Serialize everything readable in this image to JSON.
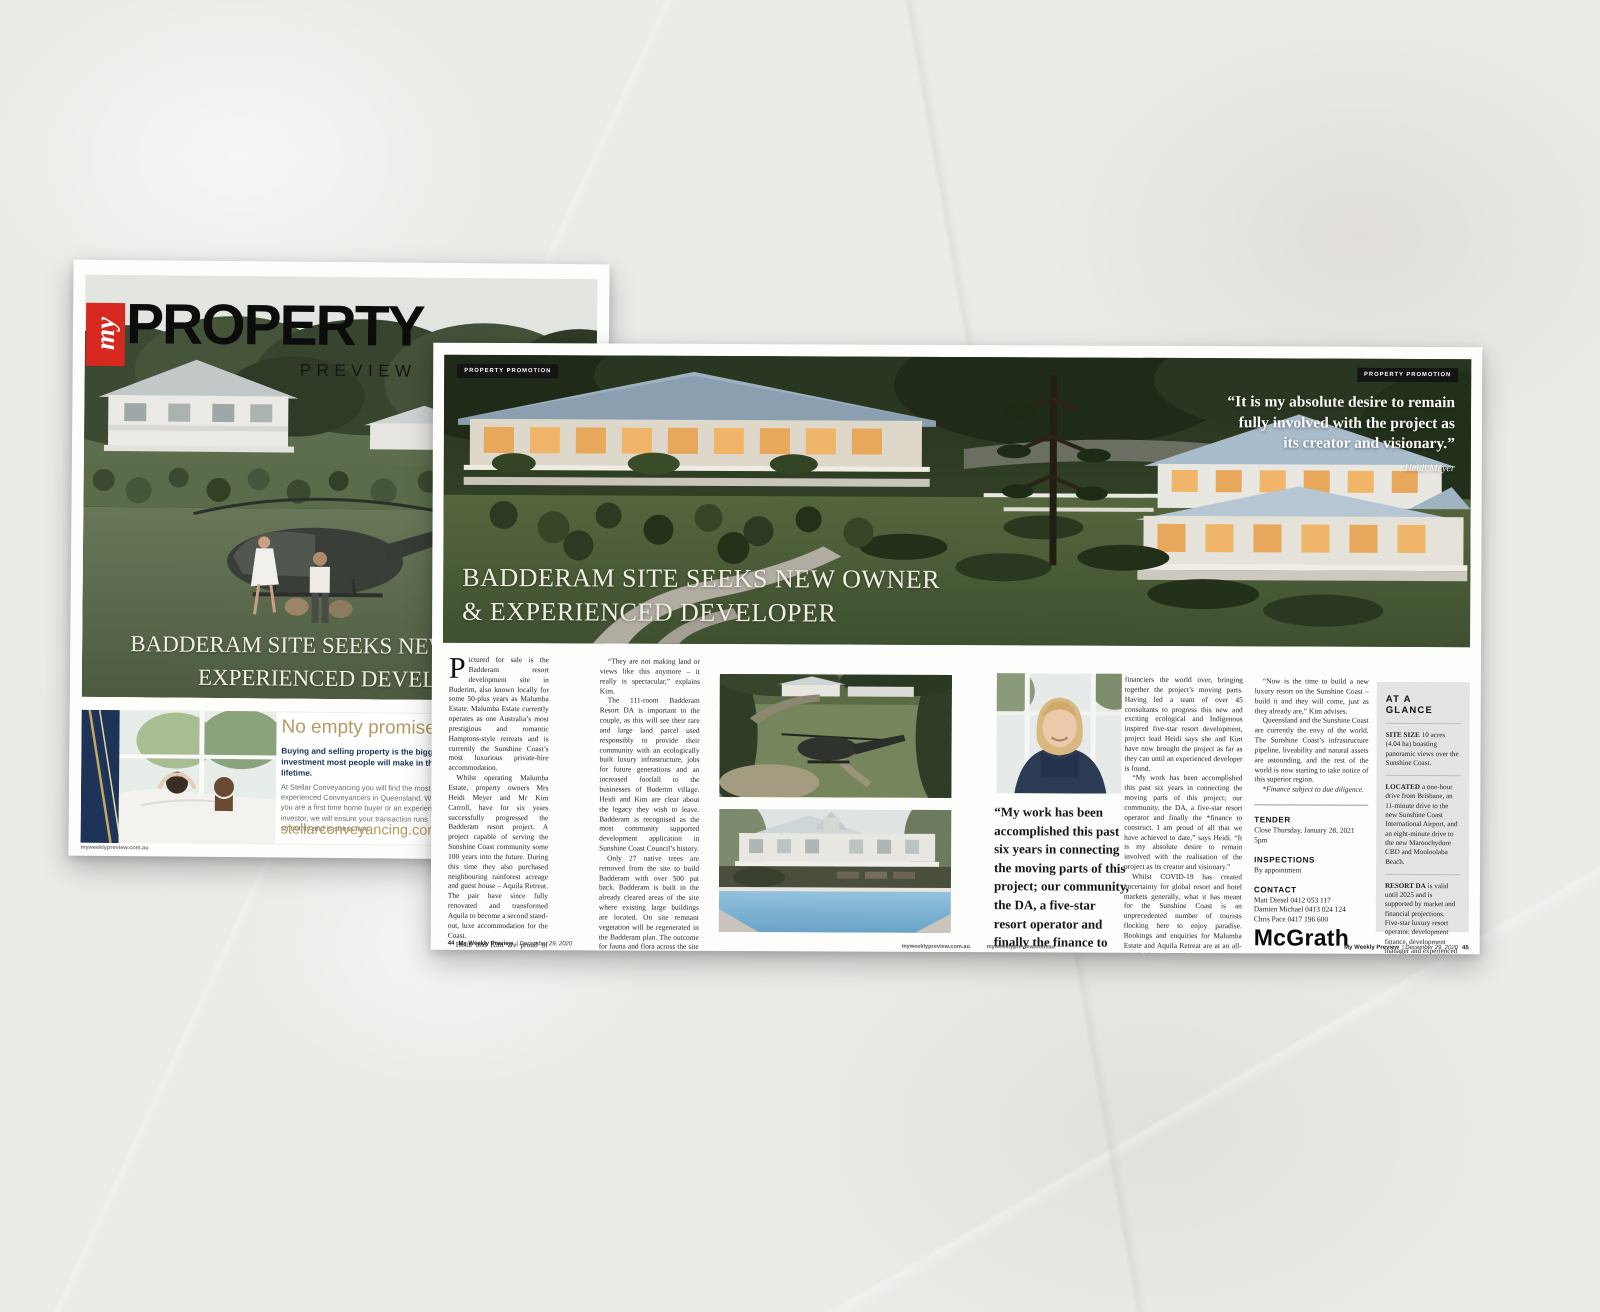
{
  "colors": {
    "masthead_red": "#d6281f",
    "ad_gold": "#b49a5e",
    "ad_navy": "#1d3357",
    "tag_bg": "#141414",
    "glance_bg": "#e4e5e2",
    "headline_ivory": "#f1eee3"
  },
  "cover": {
    "masthead": {
      "my": "my",
      "property": "PROPERTY",
      "preview": "PREVIEW"
    },
    "headline_line1": "BADDERAM SITE SEEKS NEW",
    "headline_line2": "EXPERIENCED DEVELO",
    "ad": {
      "headline": "No empty promises... just",
      "bold_lead": "Buying and selling property is the biggest investment most people will make in their lifetime.",
      "body": "At Stellar Conveyancing you will find the most experienced Conveyancers in Queensland. Whether you are a first time home buyer or an experienced investor, we will ensure your transaction runs smoothly and is stress free.",
      "url": "stellarconveyancing.com.au",
      "clipped": [
        "Call",
        "free",
        "CB01",
        "28 Ea",
        "serv"
      ]
    },
    "footer_url": "myweeklypreview.com.au"
  },
  "spread": {
    "tag_left": "PROPERTY PROMOTION",
    "tag_right": "PROPERTY PROMOTION",
    "quote": {
      "text": "“It is my absolute desire to remain fully involved with the project as its creator and visionary.”",
      "attribution": "Heidi Meyer"
    },
    "headline_line1": "BADDERAM SITE SEEKS NEW OWNER",
    "headline_line2": "& EXPERIENCED DEVELOPER",
    "article": {
      "dropcap": "P",
      "col1_p1": "ictured for sale is the Badderam resort development site in Buderim, also known locally for some 50-plus years as Malumba Estate. Malumba Estate currently operates as one Australia’s most prestigious and romantic Hamptons-style retreats and is currently the Sunshine Coast’s most luxurious private-hire accommodation.",
      "col1_p2": "Whilst operating Malumba Estate, property owners Mrs Heidi Meyer and Mr Kim Carroll, have for six years successfully progressed the Badderam resort project. A project capable of serving the Sunshine Coast community some 100 years into the future. During this time they also purchased neighbouring rainforest acreage and guest house – Aquila Retreat. The pair have since fully renovated and transformed Aquila to become a second stand-out, luxe accommodation for the Coast.",
      "col1_p3": "Heidi and Kim are proud of Buderim, the Sunshine Coast and the guests they bring to their impressive hillside to enjoy with them their stunning panoramic views across the Sunshine Coast.",
      "col2_p1": "“They are not making land or views like this anymore – it really is spectacular,” explains Kim.",
      "col2_p2": "The 111-room Badderam Resort DA is important to the couple, as this will see their rare and large land parcel used responsibly to provide their community with an ecologically built luxury infrastructure, jobs for future generations and an increased footfall to the businesses of Buderim village. Heidi and Kim are clear about the legacy they wish to leave. Badderam is recognised as the most community supported development application in Sunshine Coast Council’s history.",
      "col2_p3": "Only 27 native trees are removed from the site to build Badderam with over 500 put back. Badderam is built in the already cleared areas of the site where existing large buildings are located. On site remnant vegetation will be regenerated in the Badderam plan. The outcome for fauna and flora across the site is extremely positive.",
      "col2_p4": "Since the DA was approved in 2018, Heidi and Kim have worked tirelessly, engaging with international resort operators, potential developers and",
      "col3_p1": "financiers the world over, bringing together the project’s moving parts. Having led a team of over 45 consultants to progress this new and exciting ecological and Indigenous inspired five-star resort development, project lead Heidi says she and Kim have now brought the project as far as they can until an experienced developer is found.",
      "col3_p2": "“My work has been accomplished this past six years in connecting the moving parts of this project; our community, the DA, a five-star resort operator and finally the *finance to construct. I am proud of all that we have achieved to date,” says Heidi. “It is my absolute desire to remain involved with the realisation of the project as its creator and visionary.”",
      "col3_p3": "Whilst COVID-19 has created uncertainty for global resort and hotel markets generally, what it has meant for the Sunshine Coast is an unprecedented number of tourists flocking here to enjoy paradise. Bookings and enquiries for Malumba Estate and Aquila Retreat are at an all-time high, reports Heidi.",
      "col4_p1": "“Now is the time to build a new luxury resort on the Sunshine Coast – build it and they will come, just as they already are,” Kim advises.",
      "col4_p2": "Queensland and the Sunshine Coast are currently the envy of the world. The Sunshine Coast’s infrastructure pipeline, liveability and natural assets are astounding, and the rest of the world is now starting to take notice of this superior region.",
      "col4_note": "*Finance subject to due diligence."
    },
    "pullquote": "“My work has been accomplished this past six years in connecting the moving parts of this project; our community, the DA, a five-star resort operator and finally the finance to construct. I am proud of all that we have achieved to date.”",
    "tender": {
      "label": "TENDER",
      "value": "Close Thursday, January 28, 2021 5pm"
    },
    "inspections": {
      "label": "INSPECTIONS",
      "value": "By appointment"
    },
    "contact": {
      "label": "CONTACT",
      "lines": [
        "Matt Diesel 0412 053 117",
        "Damien Michael 0413 024 124",
        "Chris Pace 0417 196 600"
      ]
    },
    "agency_logo": "McGrath",
    "glance": {
      "title": "AT A GLANCE",
      "items": [
        {
          "lead": "SITE SIZE",
          "text": "10 acres (4.04 ha) boasting panoramic views over the Sunshine Coast."
        },
        {
          "lead": "LOCATED",
          "text": "a one-hour drive from Brisbane, an 11-minute drive to the new Sunshine Coast International Airport, and an eight-minute drive to the new Maroochydore CBD and Mooloolaba Beach."
        },
        {
          "lead": "RESORT DA",
          "text": "is valid until 2025 and is supported by market and financial projections. Five-star luxury resort operator, development finance, development manager and experienced team of consultants on standby to work with purchaser."
        }
      ],
      "links": [
        "malumbaestate.com.au",
        "badderam.com.au",
        "aquilaretreat.com.au",
        "mcgrath.com.au"
      ]
    },
    "footer": {
      "p44": "44",
      "p45": "45",
      "issue_name": "My Weekly Preview",
      "issue_date": "| December 29, 2020",
      "url": "myweeklypreview.com.au"
    }
  }
}
